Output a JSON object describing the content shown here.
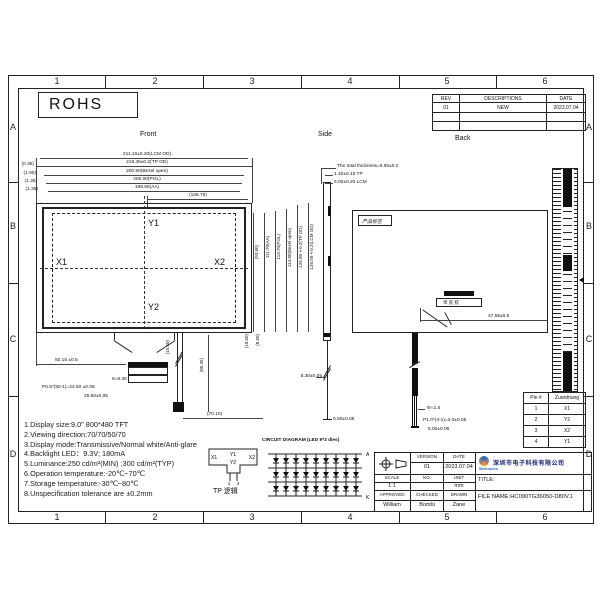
{
  "sheet": {
    "cols": [
      "1",
      "2",
      "3",
      "4",
      "5",
      "6"
    ],
    "rows": [
      "A",
      "B",
      "C",
      "D"
    ],
    "rohs_label": "ROHS",
    "view_labels": {
      "front": "Front",
      "side": "Side",
      "back": "Back"
    }
  },
  "rev_table": {
    "headers": [
      "REV",
      "DESCRIPTIONS",
      "DATE"
    ],
    "rows": [
      {
        "rev": "01",
        "desc": "NEW",
        "date": "2023.07.04"
      },
      {
        "rev": "",
        "desc": "",
        "date": ""
      },
      {
        "rev": "",
        "desc": "",
        "date": ""
      }
    ]
  },
  "front_view": {
    "dims_top": [
      "211.10±0.20(LCM OD)",
      "218.40±0.2(TP OD)",
      "200.90(Bezel open)",
      "200.00(POL)",
      "198.90(AA)",
      "(106.75)"
    ],
    "dims_left_offsets": [
      "(0.35)",
      "(1.90)",
      "(1.35)",
      "(1.35)"
    ],
    "dims_right": [
      "(93.60)",
      "111.70(AA)",
      "113.70(POL)",
      "114.00(Bezel open)",
      "125.80±0.2(TP OD)",
      "126.50±0.2(LCM OD)"
    ],
    "dims_right_bottom": [
      "(10.60)",
      "(8.60)"
    ],
    "axes": {
      "x1": "X1",
      "x2": "X2",
      "y1": "Y1",
      "y2": "Y2"
    },
    "fpc_dims": {
      "width_to_conn": "92.15 ±0.5",
      "conn_width": "9=6.35",
      "pin_pitch": "P0.5*(50-1)=24.50 ±0.05",
      "conn_total": "25.50±0.05",
      "fold_height": "(15.50)",
      "tail_length": "(80.35)",
      "tail_offset": "(70.10)"
    }
  },
  "side_view": {
    "total_thickness": "The total thickness=6.90±0.2",
    "tp_thickness": "1.40±0.15 TP",
    "lcm_thickness": "5.00±0.20 LCM",
    "tail_length": "8.30±0.05",
    "tail_end": "0.50±0.05"
  },
  "back_view": {
    "product_label": "产品标签",
    "connector_label": "单 反 胶",
    "conn_offset": "47.55±0.5",
    "tail_dims": [
      "Φ=1.5",
      "P1.0*(4-1)=3.0±0.05",
      "5.00±0.05"
    ]
  },
  "pin_table": {
    "headers": [
      "Pin #",
      "Zuordnung"
    ],
    "rows": [
      [
        "1",
        "X1"
      ],
      [
        "2",
        "Y2"
      ],
      [
        "3",
        "X2"
      ],
      [
        "4",
        "Y1"
      ]
    ]
  },
  "specs": [
    "1.Display size:9.0\" 800*480  TFT",
    "2.Viewing direction:70/70/50/70",
    "3.Display mode:Transmissive/Normal white/Anti-glare",
    "4.Backlight LED：9.3V; 180mA",
    "5.Luminance:250 cd/m²(MIN) ;300 cd/m²(TYP)",
    "6.Operation temperature:-20℃~70℃",
    "7.Storage temperature:-30℃~80℃",
    "8.Unspecification tolerance are ±0.2mm"
  ],
  "tp_logic": {
    "caption": "TP 逻辑",
    "y1": "Y1",
    "y2": "Y2",
    "x1": "X1",
    "x2": "X2",
    "pin_first": "1",
    "pin_last": "4"
  },
  "led_circuit": {
    "title": "CIRCUIT DIAGRAM (LED 9*3 dies)",
    "rows": 3,
    "cols": 9,
    "anode": "A",
    "cathode": "K"
  },
  "title_block": {
    "version_label": "VERSION",
    "version": "01",
    "date_label": "DATE",
    "date": "2023.07.04",
    "scale_label": "SCALE",
    "scale": "1:1",
    "no_label": "NO.",
    "no": "",
    "unit_label": "UNIT",
    "unit": "mm",
    "approved_label": "APPROVED",
    "approved": "William",
    "checked_label": "CHECKED",
    "checked": "Bombi",
    "drawn_label": "DRAWN",
    "drawn": "Zane",
    "title_label": "TITLE:",
    "file_name": "FILE NAME:HC090TG36050-D80V.1",
    "logo_text": "Mctronics",
    "logo_cn": "深圳市电子科技有限公司"
  }
}
